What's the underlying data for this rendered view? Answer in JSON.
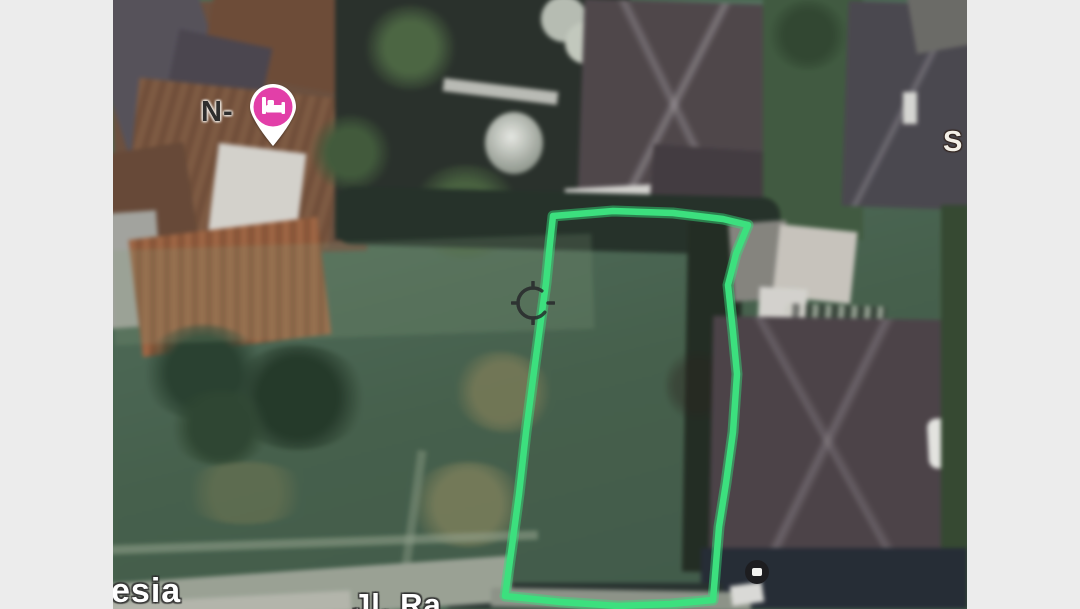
{
  "window": {
    "background_color": "#ececec",
    "view_type": "satellite"
  },
  "map": {
    "poi_pin": {
      "label": "N-",
      "icon": "bed-icon",
      "pin_color": "#e23fa8"
    },
    "street_label_right": "S",
    "watermark_fragment": "esia",
    "road_label_fragment": "Jl. Ra",
    "annotation_polygon": {
      "color": "#3ce07e",
      "points": "440,216 500,211 560,213 610,219 635,225 623,254 615,285 620,332 624,374 620,432 613,483 606,527 600,600 558,604 505,606 448,602 392,596 399,546 406,494 413,432 420,379 427,327 433,283 437,243"
    },
    "crosshair_color": "#26262a"
  }
}
